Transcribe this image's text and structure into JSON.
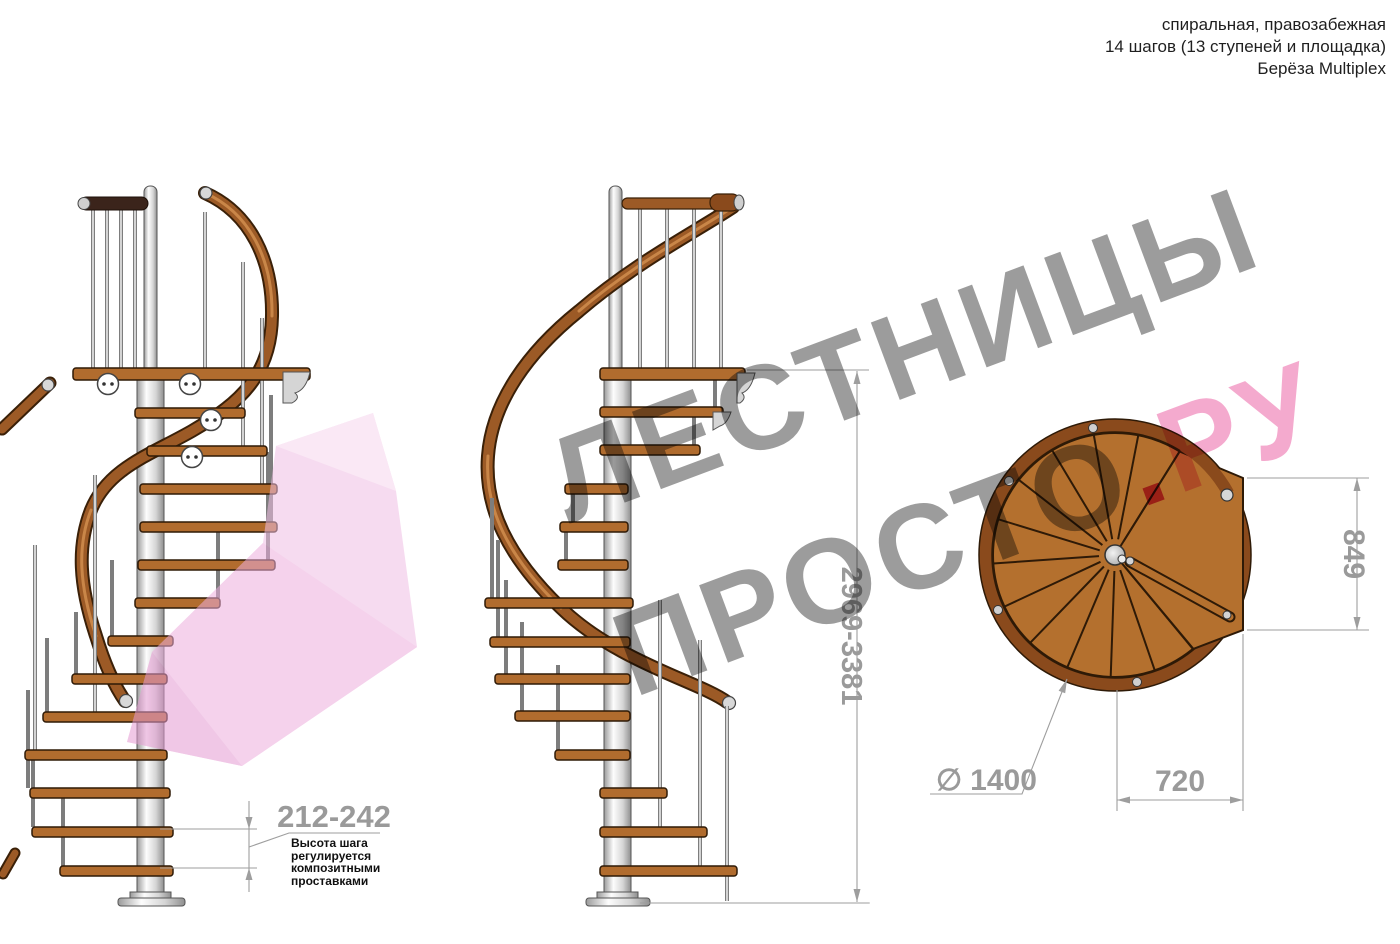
{
  "header": {
    "line1": "спиральная, правозабежная",
    "line2": "14 шагов (13 ступеней и площадка)",
    "line3": "Берёза Multiplex"
  },
  "watermark": {
    "word1": "ЛЕСТНИЦЫ",
    "word2": "ПРОСТО",
    "dot": ".",
    "word3": "РУ"
  },
  "dimensions": {
    "step_height": "212-242",
    "total_height": "2969-3381",
    "landing_depth": "849",
    "landing_width": "720",
    "diameter_symbol": "∅",
    "diameter_value": "1400"
  },
  "note": {
    "line1": "Высота шага",
    "line2": "регулируется",
    "line3": "композитными",
    "line4": "проставками"
  },
  "colors": {
    "wood": "#b4702e",
    "handrail": "#9c5a26",
    "handrail_dark": "#8a4a1c",
    "top_rail_dark": "#3b241b",
    "pole_silver": "#d9d9d9",
    "dimension_gray": "#9e9e9e",
    "watermark_gray": "#949494",
    "watermark_pink": "#f4a3ca",
    "watermark_dot_red": "#d8376f",
    "arrow_pink": "#f0bfe4",
    "note_text": "#101010"
  }
}
